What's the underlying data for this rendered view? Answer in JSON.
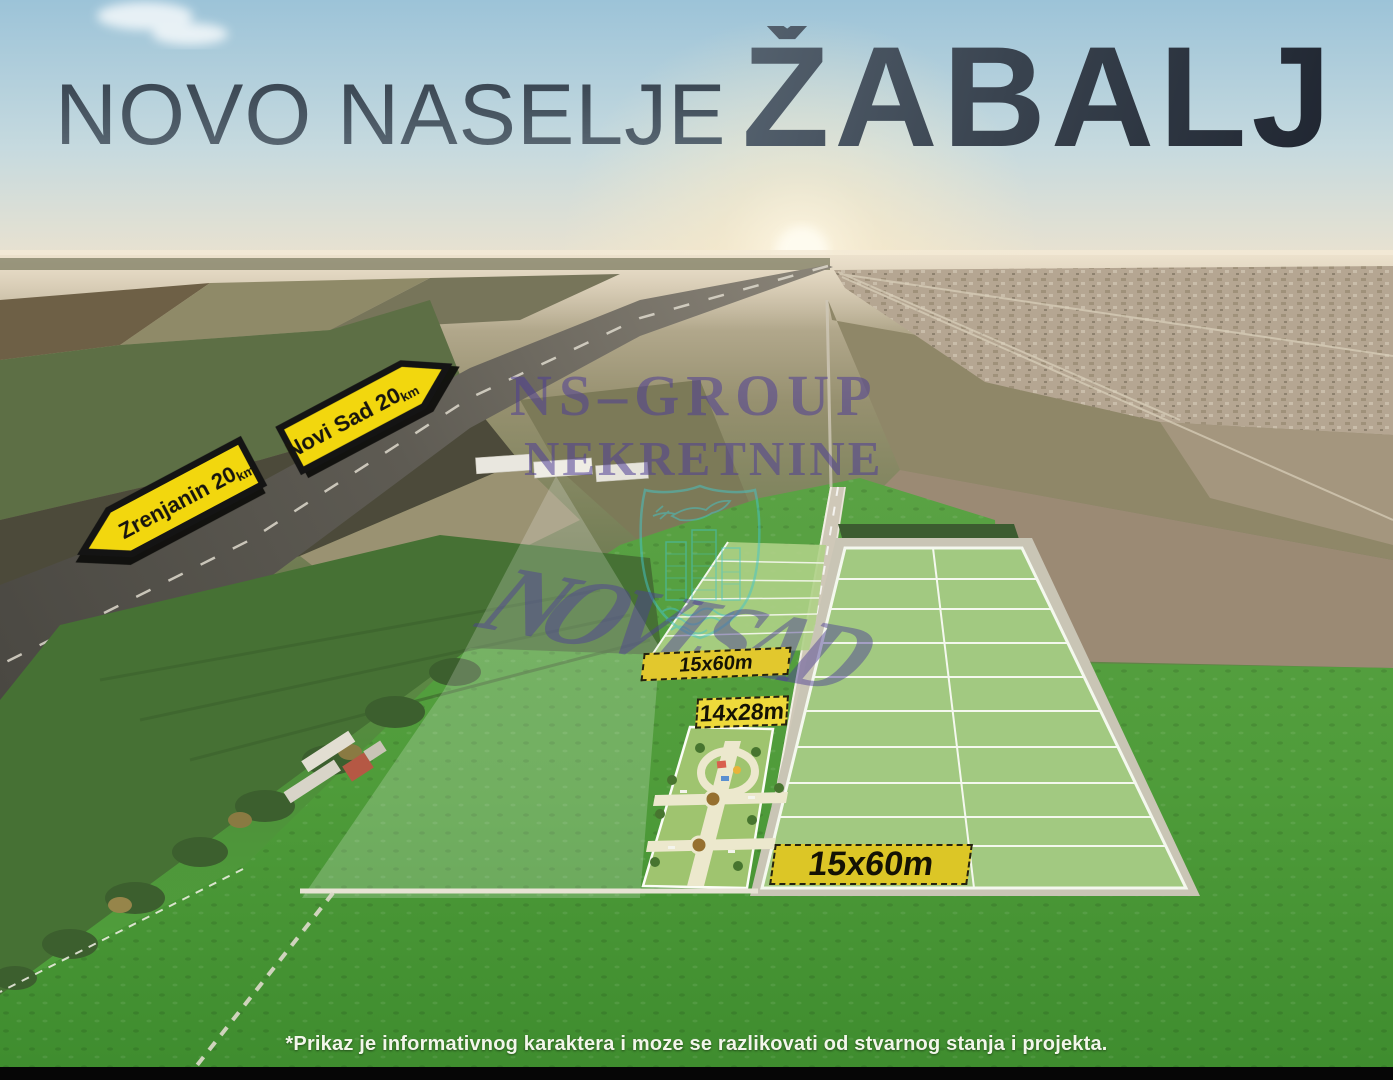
{
  "title": {
    "prefix": "NOVO NASELJE",
    "name": "ŽABALJ"
  },
  "signs": {
    "zrenjanin": {
      "label": "Zrenjanin 20",
      "unit": "km",
      "direction": "left"
    },
    "novi_sad": {
      "label": "Novi Sad 20",
      "unit": "km",
      "direction": "right"
    }
  },
  "watermark": {
    "company": "NS–GROUP",
    "company_line2": "NEKRETNINE",
    "city": "NOVI SAD",
    "logo": "city-shield-with-dove-buildings-and-waves",
    "text_color": "#4e3e96",
    "logo_color": "#46c8cc"
  },
  "plot_labels": {
    "strip": "15x60m",
    "park": "14x28m",
    "banner": "15x60m"
  },
  "footer": {
    "disclaimer": "*Prikaz je informativnog karaktera i moze se razlikovati od stvarnog stanja i projekta."
  },
  "colors": {
    "sign_yellow": "#f2d70e",
    "label_yellow": "#e2c82d",
    "plot_green": "#a2c981",
    "grass_green": "#4f9c3a",
    "title_dark": "#2c3641"
  }
}
